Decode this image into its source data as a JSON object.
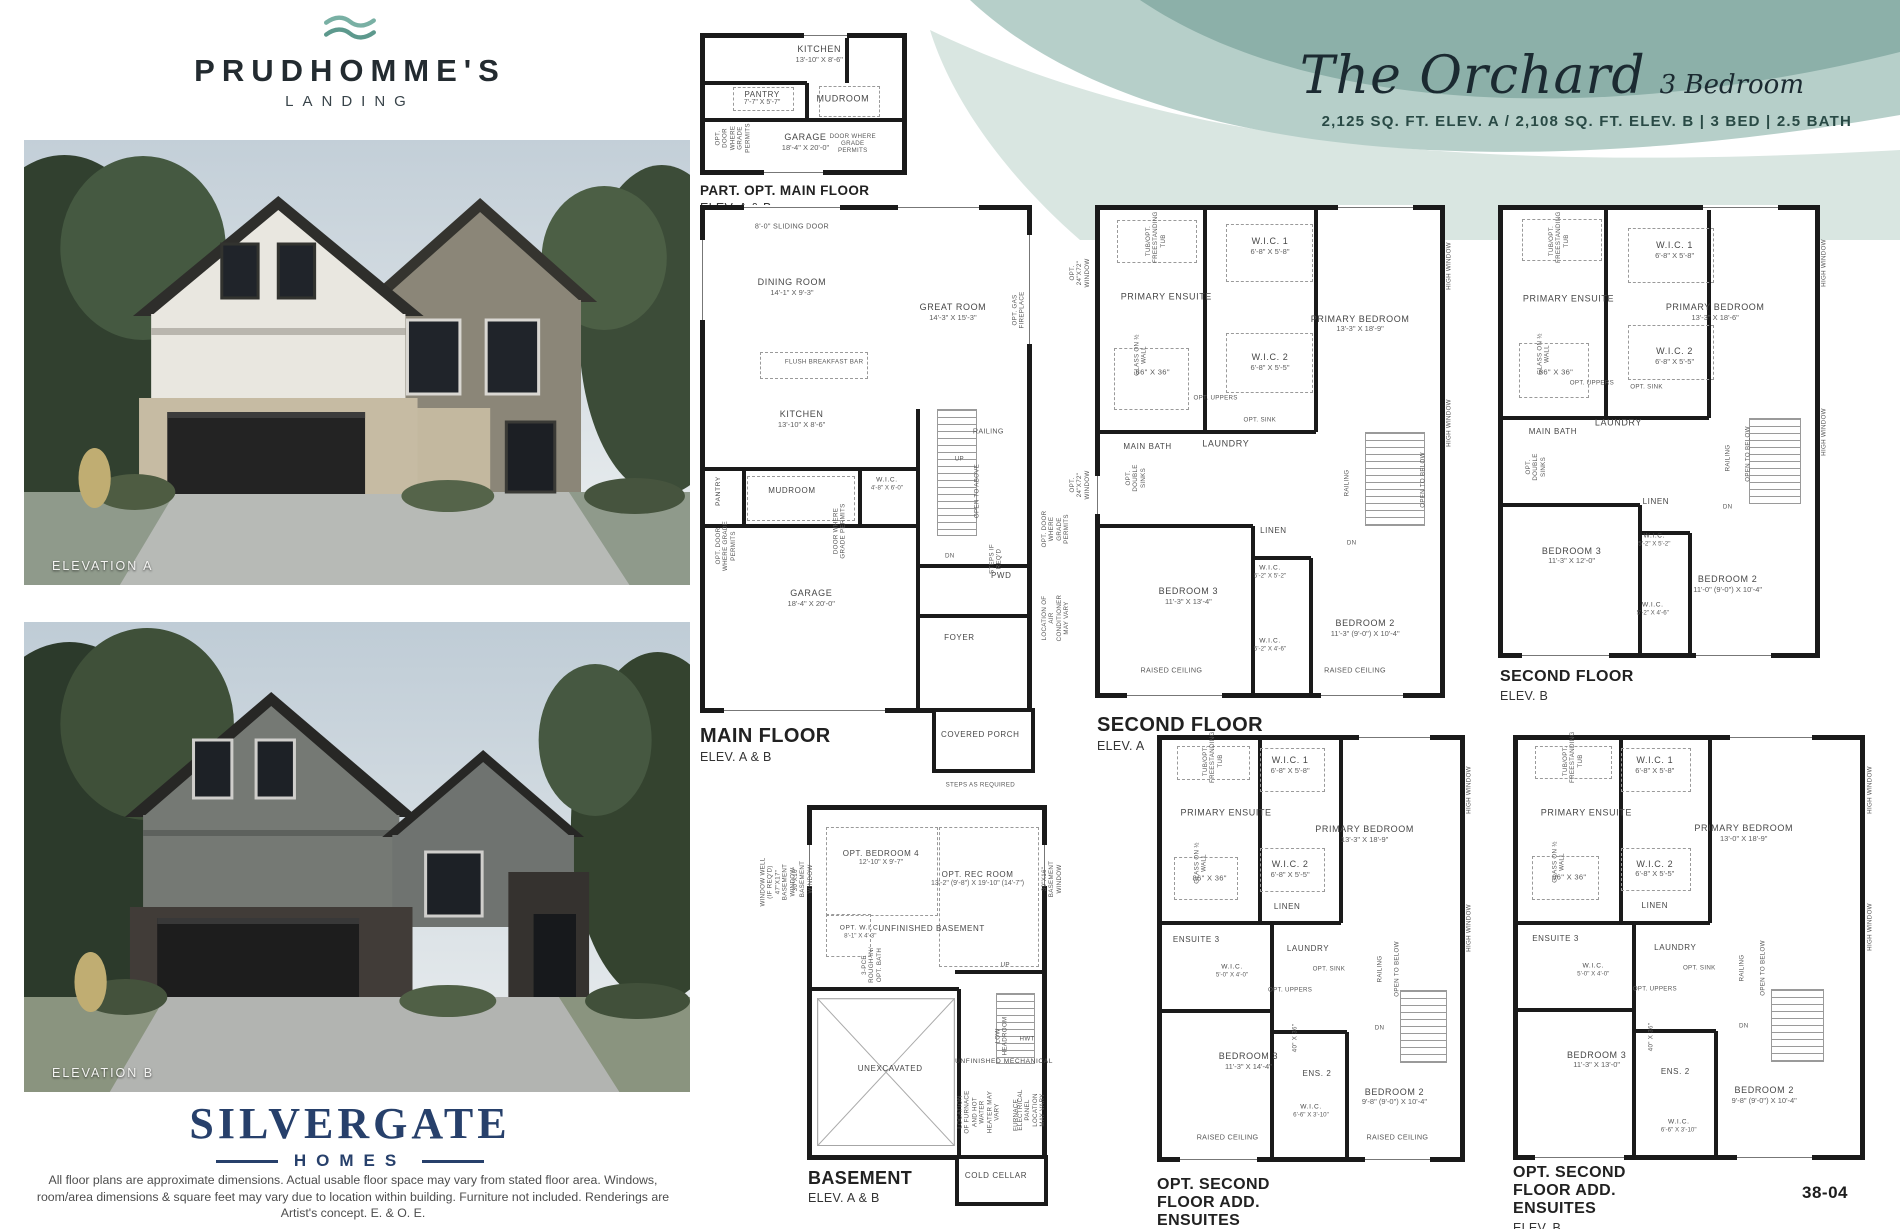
{
  "page": {
    "number": "38-04",
    "disclaimer": "All floor plans are approximate dimensions. Actual usable floor space may vary from stated floor area. Windows, room/area dimensions & square feet may vary due to location within building. Furniture not included. Renderings are Artist's concept. E. & O. E."
  },
  "header": {
    "plan_name": "The Orchard",
    "plan_type": "3 Bedroom",
    "specs": "2,125 SQ. FT. ELEV. A / 2,108 SQ. FT. ELEV. B  |  3 BED  |  2.5 BATH"
  },
  "branding": {
    "community": "PRUDHOMME'S",
    "community_sub": "LANDING",
    "builder": "SILVERGATE",
    "builder_sub": "HOMES"
  },
  "elevations": [
    {
      "label": "ELEVATION A"
    },
    {
      "label": "ELEVATION B"
    }
  ],
  "colors": {
    "teal_dark": "#8cb0a9",
    "teal_mid": "#b6cfc9",
    "teal_pale": "#d9e6e1",
    "navy": "#27406b",
    "ink": "#1b2a31",
    "wall": "#1a1a1a"
  },
  "plans": [
    {
      "id": "part-opt-main-floor",
      "title": "PART. OPT. MAIN FLOOR",
      "subtitle": "ELEV. A & B",
      "rooms": [
        {
          "name": "KITCHEN",
          "dims": "13'-10\" X 8'-6\""
        },
        {
          "name": "PANTRY",
          "dims": "7'-7\" X 5'-7\""
        },
        {
          "name": "MUDROOM"
        },
        {
          "name": "GARAGE",
          "dims": "18'-4\" X 20'-0\""
        }
      ],
      "notes": [
        "OPT. DOOR WHERE GRADE PERMITS",
        "DOOR WHERE GRADE PERMITS"
      ]
    },
    {
      "id": "main-floor",
      "title": "MAIN FLOOR",
      "subtitle": "ELEV. A & B",
      "rooms": [
        {
          "name": "DINING ROOM",
          "dims": "14'-1\" X 9'-3\""
        },
        {
          "name": "GREAT ROOM",
          "dims": "14'-3\" X 15'-3\""
        },
        {
          "name": "KITCHEN",
          "dims": "13'-10\" X 8'-6\""
        },
        {
          "name": "MUDROOM"
        },
        {
          "name": "W.I.C.",
          "dims": "4'-8\" X 6'-0\""
        },
        {
          "name": "PANTRY"
        },
        {
          "name": "GARAGE",
          "dims": "18'-4\" X 20'-0\""
        },
        {
          "name": "PWD"
        },
        {
          "name": "FOYER"
        },
        {
          "name": "COVERED PORCH"
        }
      ],
      "notes": [
        "8'-0\" SLIDING DOOR",
        "FLUSH BREAKFAST BAR",
        "OPT. GAS FIREPLACE",
        "RAILING",
        "UP",
        "OPEN TO ABOVE",
        "DN",
        "STEPS IF REQ'D",
        "DOOR WHERE GRADE PERMITS",
        "OPT. DOOR WHERE GRADE PERMITS",
        "STEPS AS REQUIRED",
        "OPT. DOOR WHERE GRADE PERMITS",
        "LOCATION OF AIR CONDITIONER MAY VARY"
      ]
    },
    {
      "id": "second-floor-a",
      "title": "SECOND FLOOR",
      "subtitle": "ELEV. A",
      "rooms": [
        {
          "name": "PRIMARY ENSUITE"
        },
        {
          "name": "W.I.C. 1",
          "dims": "6'-8\" X 5'-8\""
        },
        {
          "name": "W.I.C. 2",
          "dims": "6'-8\" X 5'-5\""
        },
        {
          "name": "PRIMARY BEDROOM",
          "dims": "13'-3\" X 18'-9\""
        },
        {
          "name": "MAIN BATH"
        },
        {
          "name": "LAUNDRY"
        },
        {
          "name": "LINEN"
        },
        {
          "name": "BEDROOM 3",
          "dims": "11'-3\" X 13'-4\""
        },
        {
          "name": "W.I.C.",
          "dims": "5'-2\" X 5'-2\""
        },
        {
          "name": "W.I.C.",
          "dims": "5'-2\" X 4'-6\""
        },
        {
          "name": "BEDROOM 2",
          "dims": "11'-3\" (9'-0\") X 10'-4\""
        }
      ],
      "notes": [
        "TUB/OPT. FREESTANDING TUB",
        "GLASS ON ½ WALL",
        "86\" X 36\"",
        "OPT. UPPERS",
        "OPT. SINK",
        "OPT. DOUBLE SINKS",
        "RAILING",
        "OPEN TO BELOW",
        "DN",
        "RAISED CEILING",
        "RAISED CEILING",
        "HIGH WINDOW",
        "HIGH WINDOW",
        "OPT. 24\"X72\" WINDOW",
        "OPT. 24\"X72\" WINDOW"
      ]
    },
    {
      "id": "second-floor-b",
      "title": "SECOND FLOOR",
      "subtitle": "ELEV. B",
      "rooms": [
        {
          "name": "PRIMARY ENSUITE"
        },
        {
          "name": "W.I.C. 1",
          "dims": "6'-8\" X 5'-8\""
        },
        {
          "name": "W.I.C. 2",
          "dims": "6'-8\" X 5'-5\""
        },
        {
          "name": "PRIMARY BEDROOM",
          "dims": "13'-3\" X 18'-6\""
        },
        {
          "name": "MAIN BATH"
        },
        {
          "name": "LAUNDRY"
        },
        {
          "name": "LINEN"
        },
        {
          "name": "BEDROOM 3",
          "dims": "11'-3\" X 12'-0\""
        },
        {
          "name": "W.I.C.",
          "dims": "5'-2\" X 5'-2\""
        },
        {
          "name": "W.I.C.",
          "dims": "5'-2\" X 4'-6\""
        },
        {
          "name": "BEDROOM 2",
          "dims": "11'-0\" (9'-0\") X 10'-4\""
        }
      ],
      "notes": [
        "TUB/OPT. FREESTANDING TUB",
        "GLASS ON ½ WALL",
        "86\" X 36\"",
        "OPT. UPPERS",
        "OPT. SINK",
        "OPT. DOUBLE SINKS",
        "RAILING",
        "OPEN TO BELOW",
        "DN",
        "HIGH WINDOW",
        "HIGH WINDOW"
      ]
    },
    {
      "id": "basement",
      "title": "BASEMENT",
      "subtitle": "ELEV. A & B",
      "rooms": [
        {
          "name": "OPT. BEDROOM 4",
          "dims": "12'-10\" X 9'-7\""
        },
        {
          "name": "OPT. REC ROOM",
          "dims": "13'-2\" (9'-8\") X 19'-10\" (14'-7\")"
        },
        {
          "name": "UNFINISHED BASEMENT"
        },
        {
          "name": "OPT. W.I.C.",
          "dims": "8'-1\" X 4'-3\""
        },
        {
          "name": "UNEXCAVATED"
        },
        {
          "name": "UNFINISHED MECHANICAL"
        },
        {
          "name": "COLD CELLAR"
        }
      ],
      "notes": [
        "3-PCE ROUGH-IN/ OPT. BATH",
        "UP",
        "LOW HEADROOM",
        "HWT",
        "FURNACE",
        "LOCATION OF FURNACE AND HOT WATER HEATER MAY VARY",
        "ELECTRICAL PANEL LOCATION MAY VARY",
        "WINDOW WELL (IF REQ'D) 47\"X17\" BASEMENT WINDOW",
        "30\"X16\" BASEMENT WINDOW",
        "30\"X16\" BASEMENT WINDOW"
      ]
    },
    {
      "id": "opt-second-floor-a",
      "title": "OPT. SECOND FLOOR ADD. ENSUITES",
      "subtitle": "ELEV. A",
      "rooms": [
        {
          "name": "PRIMARY ENSUITE"
        },
        {
          "name": "W.I.C. 1",
          "dims": "6'-8\" X 5'-8\""
        },
        {
          "name": "W.I.C. 2",
          "dims": "6'-8\" X 5'-5\""
        },
        {
          "name": "PRIMARY BEDROOM",
          "dims": "13'-3\" X 18'-9\""
        },
        {
          "name": "ENSUITE 3"
        },
        {
          "name": "W.I.C.",
          "dims": "5'-0\" X 4'-0\""
        },
        {
          "name": "LINEN"
        },
        {
          "name": "LAUNDRY"
        },
        {
          "name": "BEDROOM 3",
          "dims": "11'-3\" X 14'-4\""
        },
        {
          "name": "ENS. 2"
        },
        {
          "name": "W.I.C.",
          "dims": "6'-6\" X 3'-10\""
        },
        {
          "name": "BEDROOM 2",
          "dims": "9'-8\" (9'-0\") X 10'-4\""
        }
      ],
      "notes": [
        "TUB/OPT. FREESTANDING TUB",
        "GLASS ON ½ WALL",
        "86\" X 36\"",
        "OPT. SINK",
        "OPT. UPPERS",
        "40\" X 36\"",
        "RAILING",
        "OPEN TO BELOW",
        "DN",
        "RAISED CEILING",
        "RAISED CEILING",
        "HIGH WINDOW",
        "HIGH WINDOW"
      ]
    },
    {
      "id": "opt-second-floor-b",
      "title": "OPT. SECOND FLOOR ADD. ENSUITES",
      "subtitle": "ELEV. B",
      "rooms": [
        {
          "name": "PRIMARY ENSUITE"
        },
        {
          "name": "W.I.C. 1",
          "dims": "6'-8\" X 5'-8\""
        },
        {
          "name": "W.I.C. 2",
          "dims": "6'-8\" X 5'-5\""
        },
        {
          "name": "PRIMARY BEDROOM",
          "dims": "13'-0\" X 18'-9\""
        },
        {
          "name": "ENSUITE 3"
        },
        {
          "name": "W.I.C.",
          "dims": "5'-0\" X 4'-0\""
        },
        {
          "name": "LINEN"
        },
        {
          "name": "LAUNDRY"
        },
        {
          "name": "BEDROOM 3",
          "dims": "11'-3\" X 13'-0\""
        },
        {
          "name": "ENS. 2"
        },
        {
          "name": "W.I.C.",
          "dims": "6'-6\" X 3'-10\""
        },
        {
          "name": "BEDROOM 2",
          "dims": "9'-8\" (9'-0\") X 10'-4\""
        }
      ],
      "notes": [
        "TUB/OPT. FREESTANDING TUB",
        "GLASS ON ½ WALL",
        "86\" X 36\"",
        "OPT. SINK",
        "OPT. UPPERS",
        "40\" X 36\"",
        "RAILING",
        "OPEN TO BELOW",
        "DN",
        "HIGH WINDOW",
        "HIGH WINDOW"
      ]
    }
  ]
}
